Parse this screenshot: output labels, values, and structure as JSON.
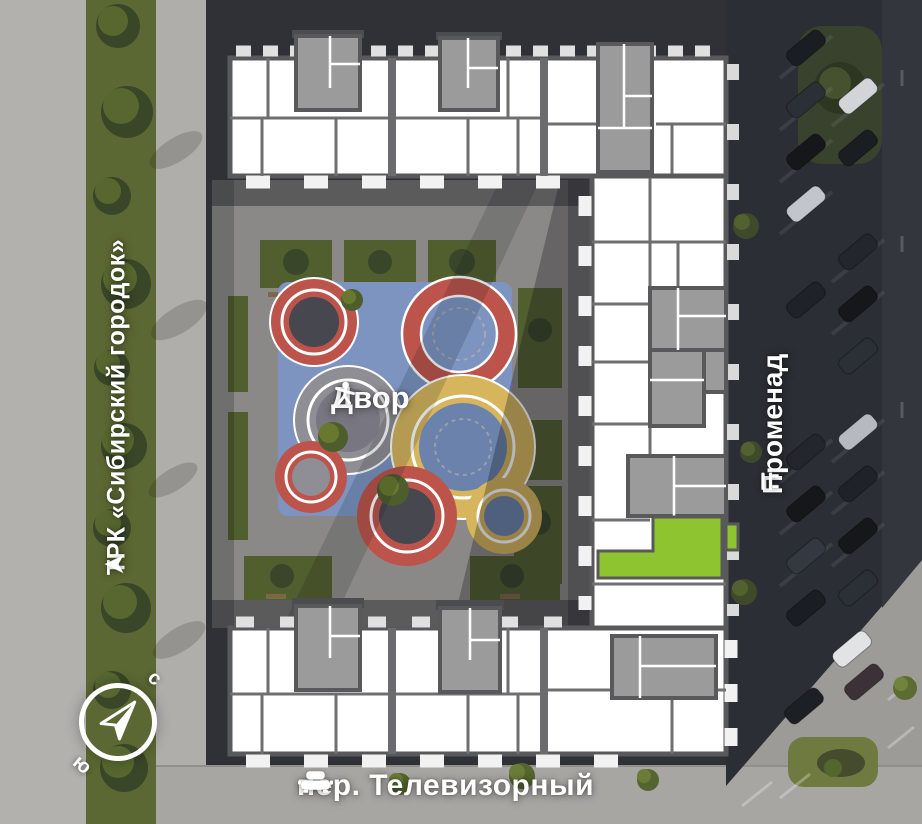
{
  "labels": {
    "courtyard": "Двор",
    "street": "пер. Телевизорный",
    "mall": "ТРК «Сибирский городок»",
    "promenade": "Променад"
  },
  "compass": {
    "north": "с",
    "south": "ю"
  },
  "colors": {
    "selected_unit_fill": "#8ec42f",
    "plan_wall": "#59595b",
    "plan_core": "#9b9b9c",
    "playground_blue": "#7d94c0",
    "playground_red": "#bc544b",
    "playground_yellow": "#d6b55c",
    "label_text": "#ffffff"
  },
  "icons": {
    "courtyard": "person-playing-icon",
    "street": "car-icon",
    "mall": "direction-arrow-icon",
    "promenade": "bench-icon",
    "compass": "compass-needle-icon"
  }
}
